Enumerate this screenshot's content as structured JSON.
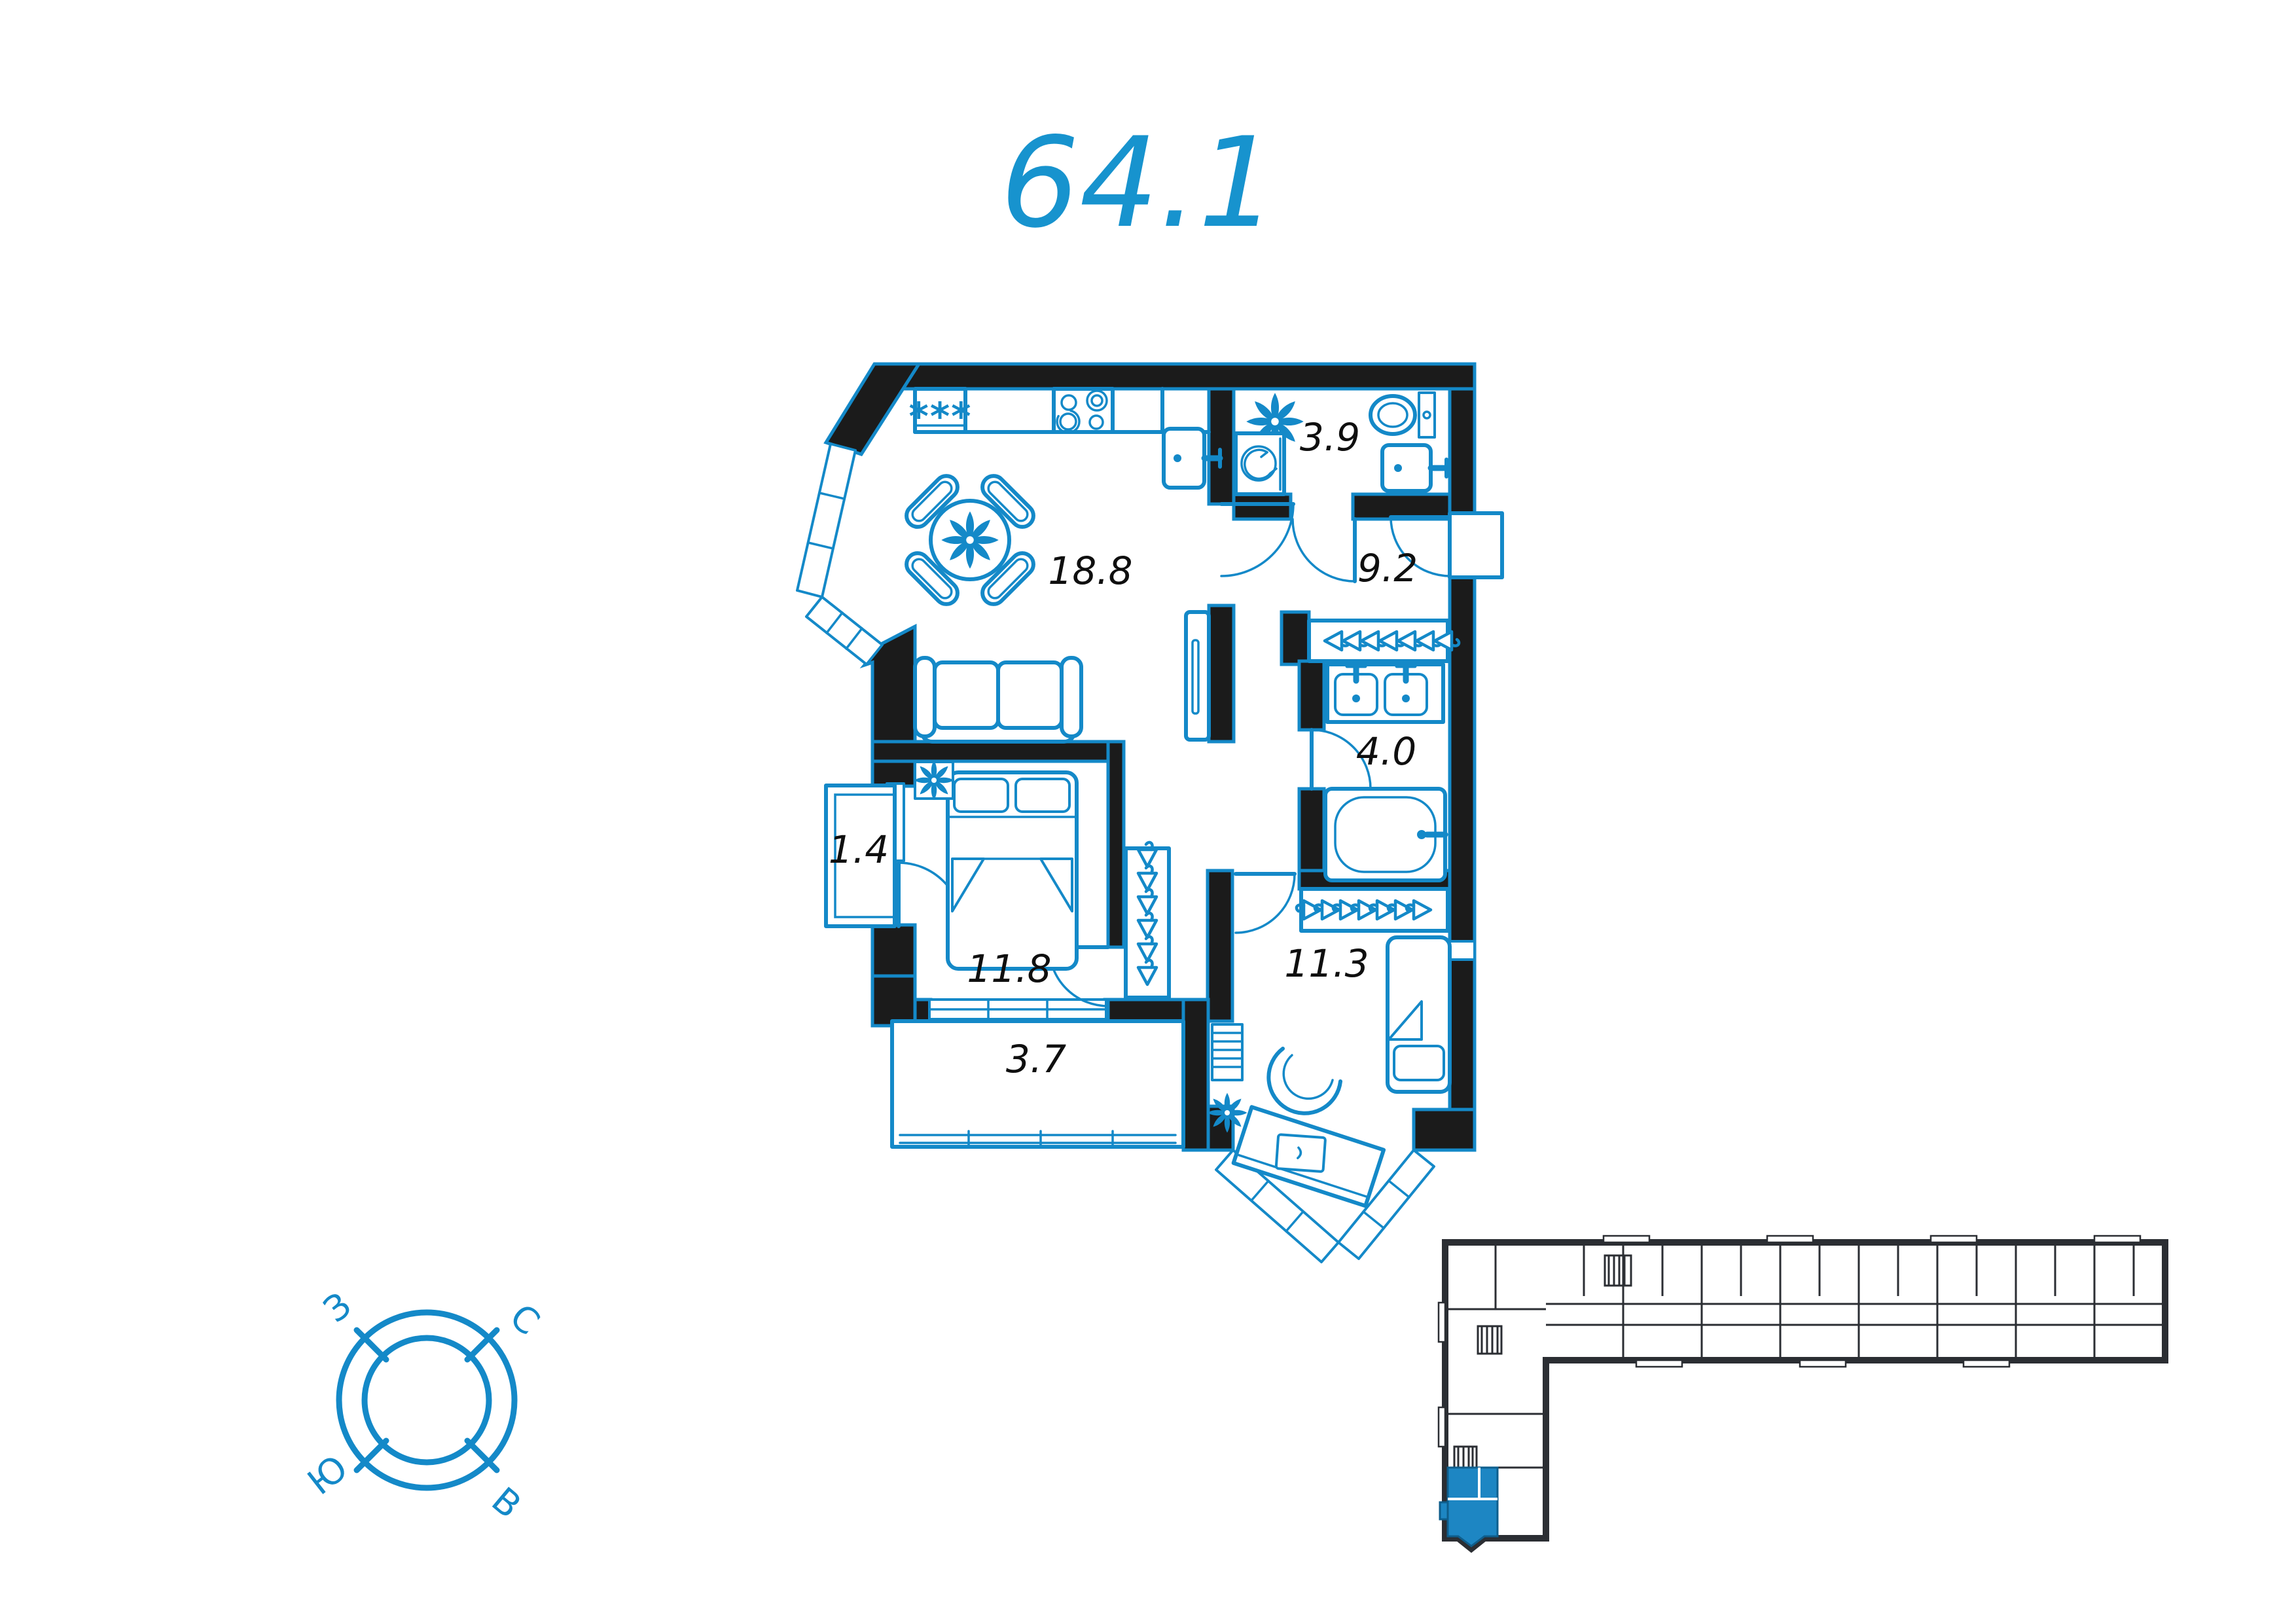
{
  "title": {
    "value": "64.1"
  },
  "plan": {
    "rooms": [
      {
        "name": "kitchen-living",
        "area": "18.8"
      },
      {
        "name": "bathroom-small",
        "area": "3.9"
      },
      {
        "name": "hallway",
        "area": "9.2"
      },
      {
        "name": "bathroom",
        "area": "4.0"
      },
      {
        "name": "balcony",
        "area": "1.4"
      },
      {
        "name": "bedroom",
        "area": "11.8"
      },
      {
        "name": "loggia",
        "area": "3.7"
      },
      {
        "name": "bedroom-second",
        "area": "11.3"
      }
    ],
    "fridge_label": "***"
  },
  "compass": {
    "west": "З",
    "north": "С",
    "south": "Ю",
    "east": "В"
  },
  "colors": {
    "accent": "#1489c8",
    "title_blue": "#1793ce",
    "wall_black": "#1b1b1b",
    "keyplan_dark": "#2b2e33",
    "highlight": "#1d86c3",
    "label_black": "#0f0f0f"
  },
  "icons": {
    "plant-icon": "flower-shape",
    "hanger-icon": "triangle-with-hook",
    "stairs-icon": "rect-with-rungs",
    "burner-icon": "circles",
    "compass-icon": "double-circle-with-ticks"
  }
}
